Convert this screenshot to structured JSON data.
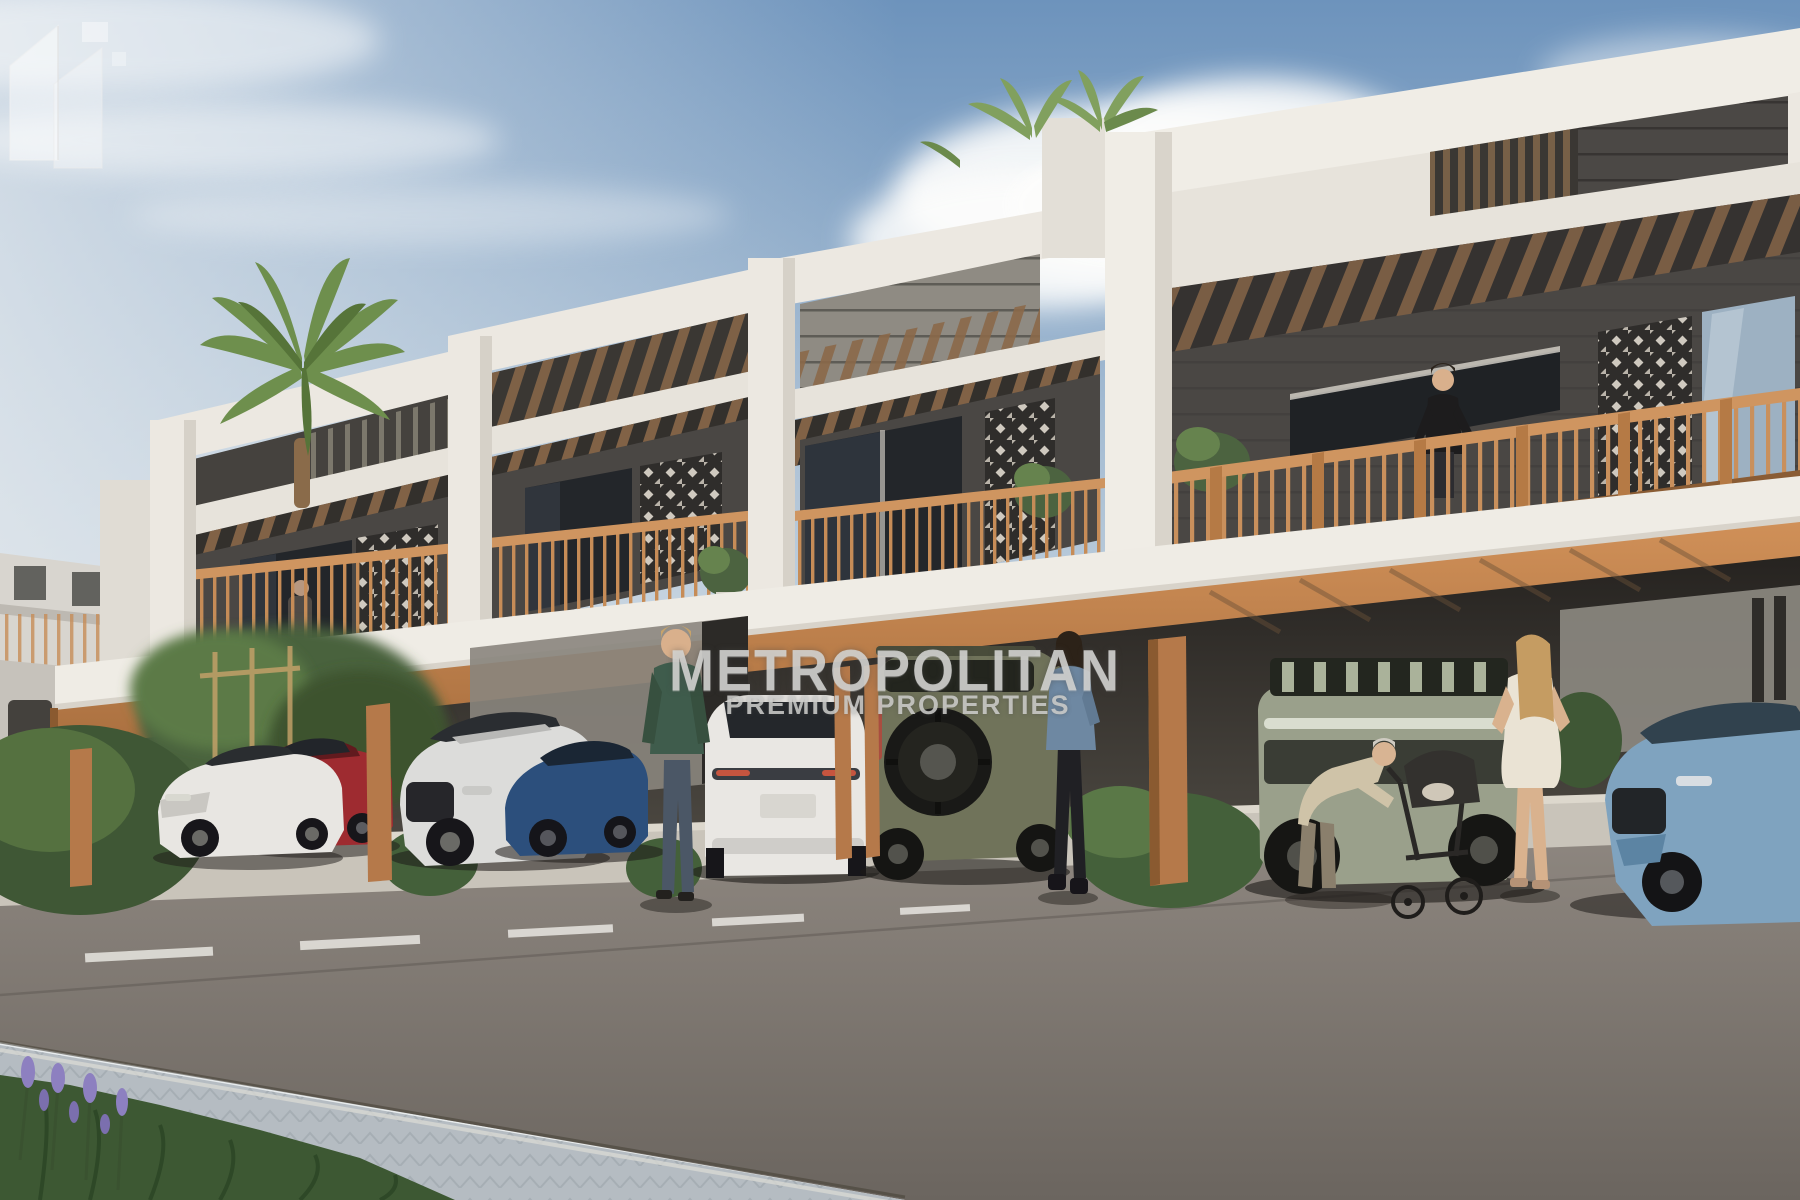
{
  "watermark": {
    "brand": "METROPOLITAN",
    "tagline": "PREMIUM PROPERTIES",
    "logo_icon": "metropolitan-buildings-logo",
    "text_color": "#d3d3d1"
  },
  "scene": {
    "description": "Daytime 3D architectural rendering of a row of modern two-storey townhouses with wooden pergolas, mashrabiya lattice screens and balconies above a covered parking level; cars are parked under the canopy, pedestrians on the sidewalk, asphalt road and paved walkway in the foreground.",
    "sky": {
      "top_color": "#6d93bc",
      "horizon_color": "#eef0ee",
      "clouds": "white cumulus behind rooflines"
    },
    "building": {
      "wall_color": "#ece8e1",
      "stone_color": "#4a4744",
      "wood_color": "#c28150",
      "units_visible": 4
    },
    "vehicles": [
      "white sedan",
      "red coupe",
      "silver SUV",
      "dark blue sports sedan",
      "white SUV seen from rear",
      "olive off-road SUV with rear spare wheel",
      "sage green electric truck",
      "light blue sedan"
    ],
    "people": [
      "man in green sweater",
      "woman in denim jacket",
      "woman in black on balcony",
      "elderly person leaning over a stroller",
      "woman in white dress"
    ],
    "landscape": [
      "palm tree",
      "rooftop palms",
      "shrubs and hedges",
      "purple lavender flowers",
      "asphalt road with white dashed lane marking",
      "herringbone paved sidewalk"
    ]
  }
}
